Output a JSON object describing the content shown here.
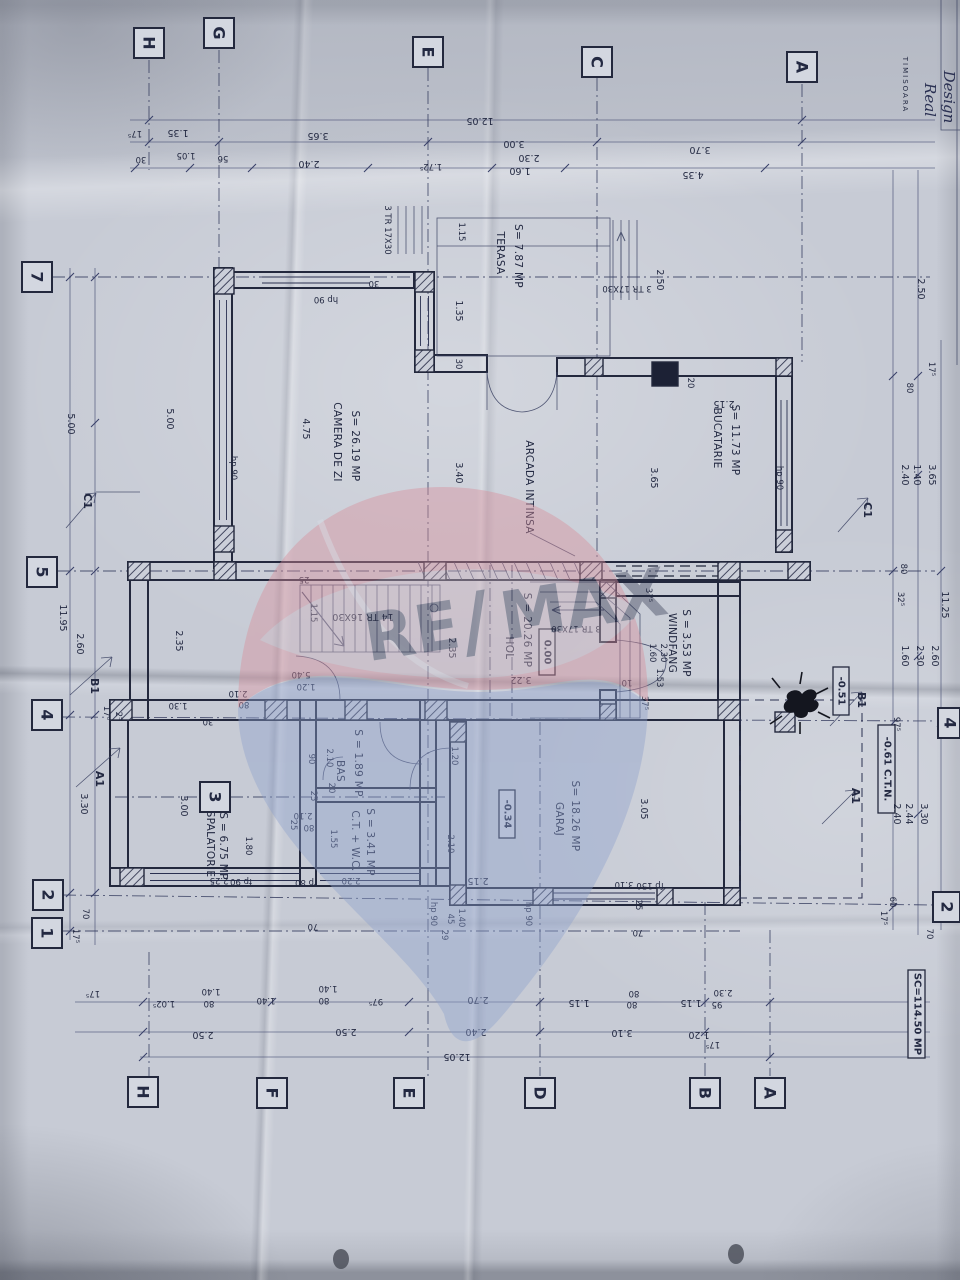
{
  "sheet": {
    "area_note": "SC=114.50 MP",
    "logo": {
      "city": "TIMISOARA",
      "brand1": "Real",
      "brand2": "Design"
    }
  },
  "watermark": {
    "re": "RE",
    "slash": "/",
    "max": "MAX",
    "brand": "RE/MAX"
  },
  "grid": {
    "top": [
      "H",
      "G",
      "E",
      "C",
      "A"
    ],
    "left": [
      "7",
      "5",
      "4",
      "2",
      "1"
    ],
    "right": [
      "4",
      "2"
    ],
    "bottom": [
      "H",
      "F",
      "E",
      "D",
      "B",
      "A"
    ],
    "inner": [
      "3"
    ]
  },
  "rooms": [
    {
      "name": "CAMERA DE ZI",
      "area": "S= 26.19 MP"
    },
    {
      "name": "TERASA",
      "area": "S= 7.87 MP"
    },
    {
      "name": "BUCATARIE",
      "area": "S= 11.73 MP"
    },
    {
      "name": "ARCADA INTINSA",
      "area": ""
    },
    {
      "name": "HOL",
      "area": "S = 20.26 MP"
    },
    {
      "name": "WINDFANG",
      "area": "S = 3.53 MP"
    },
    {
      "name": "SPALATORIE",
      "area": "S = 6.75 MP"
    },
    {
      "name": "BAS",
      "area": "S = 1.89 MP"
    },
    {
      "name": "C.T. + W.C.",
      "area": "S = 3.41 MP"
    },
    {
      "name": "GARAJ",
      "area": "S= 18.26 MP"
    }
  ],
  "levels": {
    "hol": "0.00",
    "windfang": "-0.51",
    "garaj": "-0.34",
    "teren": "-0.61 C.T.N."
  },
  "stairs": {
    "main": "14 TR 16X30",
    "terasa_upper": "3 TR 17X30",
    "terasa_left": "3 TR 17X30",
    "entry": "3 TR 17X30"
  },
  "sections": {
    "c1": "C1",
    "b1": "B1",
    "a1": "A1"
  },
  "dims": {
    "top": [
      "12.05",
      "1.35",
      "3.65",
      "3.00",
      "3.70",
      "2.30",
      "2.40",
      "1.60",
      "4.35",
      "1.05",
      "56",
      "30",
      "17⁵",
      "1.72⁵",
      "1.15",
      "2.50"
    ],
    "left": [
      "5.00",
      "5.00",
      "11.95",
      "2.60",
      "2.35",
      "3.30",
      "70",
      "17⁵",
      "17⁵",
      "2⁵"
    ],
    "right": [
      "2.50",
      "17⁵",
      "80",
      "2.40",
      "1.40",
      "3.65",
      "32⁵",
      "11.25",
      "1.60",
      "2.30",
      "2.60",
      "97⁵",
      "2.40",
      "2.44",
      "3.30",
      "60",
      "17⁵",
      "70",
      "80"
    ],
    "bottom": [
      "1.02⁵",
      "1.40",
      "80",
      "1.40",
      "1.40",
      "80",
      "97⁵",
      "2.70",
      "1.15",
      "80",
      "80",
      "1.15",
      "2.30",
      "95",
      "2.50",
      "2.50",
      "2.40",
      "3.10",
      "1.20",
      "17⁵",
      "12.05",
      "17⁵"
    ],
    "inner": [
      "4.75",
      "3.40",
      "1.35",
      "30",
      "30",
      "2.15",
      "20",
      "3.65",
      "25",
      "1.15",
      "2.35",
      "5.40",
      "1.20",
      "2.10",
      "80",
      "1.30",
      "37⁵",
      "37⁵",
      "1.60",
      "2.30",
      "10",
      "1.53",
      "3.22",
      "2.10",
      "90",
      "20",
      "25",
      "2.10",
      "80",
      "25",
      "1.55",
      "2.20",
      "70",
      "1.80",
      "3.00",
      "2.25",
      "1.20",
      "2.10",
      "2.15",
      "3.05",
      "3.10",
      "25",
      "70",
      "45",
      "1.40",
      "29",
      "30"
    ],
    "windows": [
      "hp 90",
      "fp 90",
      "fp 80",
      "fp 150"
    ]
  }
}
